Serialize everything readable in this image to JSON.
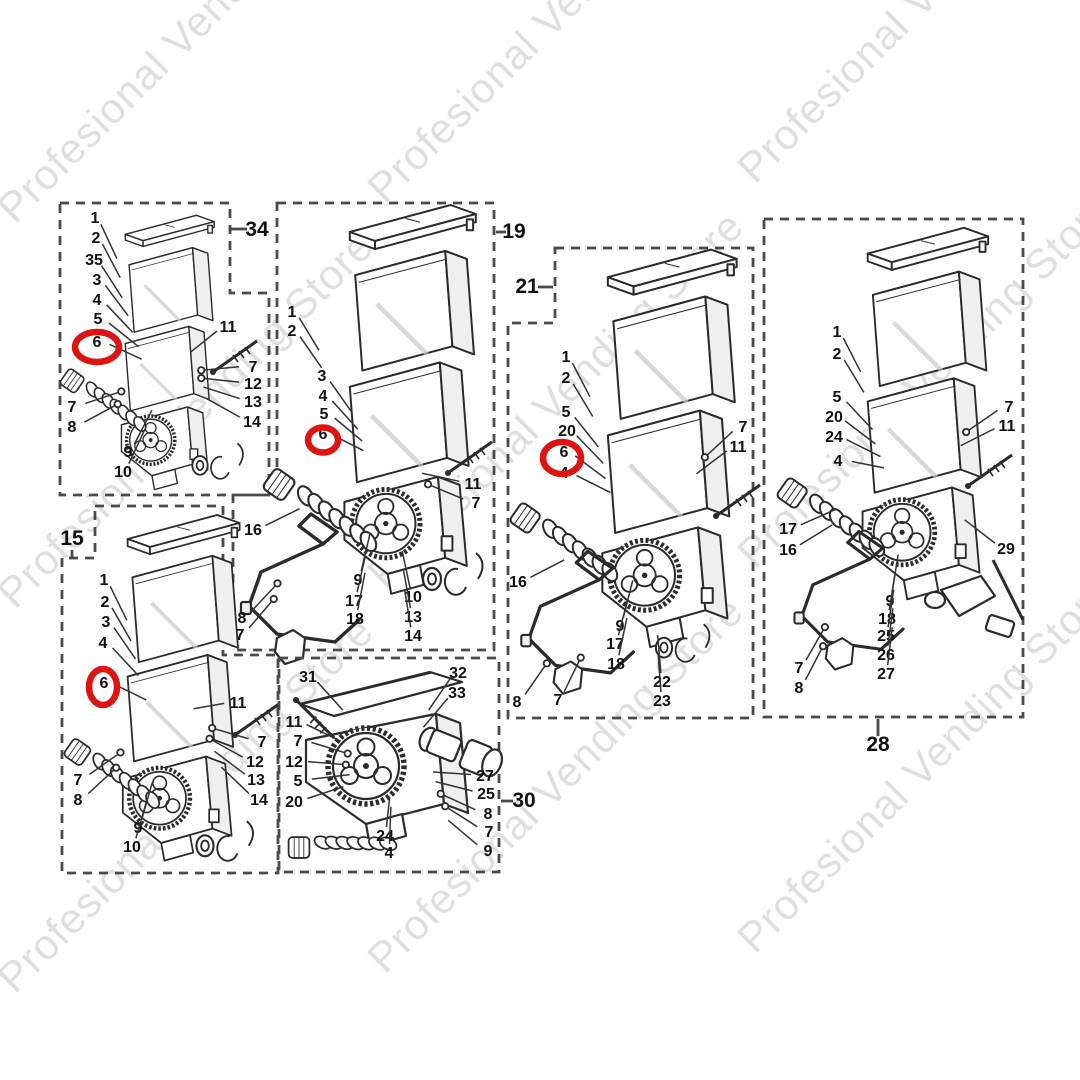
{
  "watermark": {
    "text": "Profesional Vending Store"
  },
  "colors": {
    "line": "#2b2b2b",
    "panel_border": "#4a4a4a",
    "highlight": "#dd1512",
    "watermark": "#c6c6c6"
  },
  "diagram_type": "exploded-parts-diagram",
  "panels": [
    {
      "id": "34",
      "border": "M60,203 H230 V293 H269 V495 H60 Z",
      "label": {
        "text": "34",
        "x": 257,
        "y": 236,
        "tick": [
          231,
          229,
          247,
          229
        ]
      },
      "focus": [
        168,
        380
      ],
      "draw": [
        {
          "sym": "stackA",
          "x": 124,
          "y": 228,
          "s": 0.635
        },
        {
          "sym": "auger",
          "x": 88,
          "y": 388,
          "s": 0.72
        },
        {
          "sym": "screw",
          "x": 213,
          "y": 372,
          "s": 1
        },
        {
          "sym": "clip",
          "x": 200,
          "y": 462,
          "s": 0.85
        }
      ],
      "highlight": {
        "cx": 97,
        "cy": 347,
        "rx": 22,
        "ry": 15
      },
      "parts": [
        [
          "1",
          95,
          223
        ],
        [
          "2",
          96,
          243
        ],
        [
          "35",
          94,
          265
        ],
        [
          "3",
          97,
          285
        ],
        [
          "4",
          97,
          305
        ],
        [
          "5",
          98,
          324
        ],
        [
          "6",
          97,
          347
        ],
        [
          "11",
          228,
          332
        ],
        [
          "7",
          253,
          372
        ],
        [
          "12",
          253,
          389
        ],
        [
          "13",
          253,
          407
        ],
        [
          "14",
          252,
          427
        ],
        [
          "7",
          72,
          412
        ],
        [
          "8",
          72,
          432
        ],
        [
          "9",
          128,
          457
        ],
        [
          "10",
          123,
          477
        ]
      ]
    },
    {
      "id": "19",
      "border": "M277,203 H494 V650 H233 V495 H277 Z",
      "label": {
        "text": "19",
        "x": 514,
        "y": 238,
        "tick": [
          496,
          232,
          506,
          232
        ]
      },
      "focus": [
        385,
        470
      ],
      "draw": [
        {
          "sym": "stackA",
          "x": 348,
          "y": 223,
          "s": 0.9
        },
        {
          "sym": "auger",
          "x": 300,
          "y": 494,
          "s": 0.95
        },
        {
          "sym": "screw",
          "x": 448,
          "y": 473,
          "s": 1
        },
        {
          "sym": "wire",
          "x": 247,
          "y": 520,
          "s": 1
        },
        {
          "sym": "clip",
          "x": 432,
          "y": 575,
          "s": 1
        }
      ],
      "highlight": {
        "cx": 323,
        "cy": 440,
        "rx": 15,
        "ry": 12.5
      },
      "parts": [
        [
          "1",
          292,
          317
        ],
        [
          "2",
          292,
          336
        ],
        [
          "3",
          322,
          381
        ],
        [
          "4",
          323,
          401
        ],
        [
          "5",
          324,
          419
        ],
        [
          "6",
          323,
          439
        ],
        [
          "11",
          473,
          489
        ],
        [
          "7",
          476,
          508
        ],
        [
          "16",
          253,
          535
        ],
        [
          "9",
          358,
          585
        ],
        [
          "10",
          413,
          602
        ],
        [
          "17",
          354,
          606
        ],
        [
          "13",
          413,
          622
        ],
        [
          "18",
          355,
          624
        ],
        [
          "8",
          242,
          623
        ],
        [
          "7",
          240,
          640
        ],
        [
          "14",
          413,
          641
        ]
      ]
    },
    {
      "id": "21",
      "border": "M555,248 H753 V718 H508 V323 H555 Z",
      "label": {
        "text": "21",
        "x": 527,
        "y": 293,
        "tick": [
          538,
          287,
          553,
          287
        ]
      },
      "focus": [
        648,
        520
      ],
      "draw": [
        {
          "sym": "stackA",
          "x": 606,
          "y": 268,
          "s": 0.92
        },
        {
          "sym": "auger",
          "x": 545,
          "y": 527,
          "s": 0.9
        },
        {
          "sym": "screw",
          "x": 716,
          "y": 516,
          "s": 1
        },
        {
          "sym": "wire",
          "x": 527,
          "y": 557,
          "s": 0.95
        },
        {
          "sym": "clip",
          "x": 664,
          "y": 644,
          "s": 0.9
        }
      ],
      "highlight": {
        "cx": 562,
        "cy": 458,
        "rx": 19,
        "ry": 16
      },
      "parts": [
        [
          "1",
          566,
          362
        ],
        [
          "2",
          566,
          383
        ],
        [
          "5",
          566,
          417
        ],
        [
          "20",
          567,
          436
        ],
        [
          "6",
          564,
          457
        ],
        [
          "4",
          564,
          478
        ],
        [
          "7",
          743,
          432
        ],
        [
          "11",
          738,
          452
        ],
        [
          "16",
          518,
          587
        ],
        [
          "9",
          620,
          631
        ],
        [
          "17",
          615,
          649
        ],
        [
          "18",
          616,
          669
        ],
        [
          "22",
          662,
          687
        ],
        [
          "23",
          662,
          706
        ],
        [
          "8",
          517,
          707
        ],
        [
          "7",
          558,
          705
        ]
      ]
    },
    {
      "id": "28",
      "border": "M764,219 H1023 V717 H764 Z",
      "label": {
        "text": "28",
        "x": 878,
        "y": 751,
        "tick": [
          878,
          719,
          878,
          736
        ]
      },
      "focus": [
        910,
        480
      ],
      "draw": [
        {
          "sym": "stackA",
          "x": 866,
          "y": 245,
          "s": 0.86
        },
        {
          "sym": "auger",
          "x": 812,
          "y": 502,
          "s": 0.9
        },
        {
          "sym": "screw",
          "x": 968,
          "y": 486,
          "s": 1
        },
        {
          "sym": "wire",
          "x": 800,
          "y": 537,
          "s": 0.92
        },
        {
          "sym": "lever",
          "x": 935,
          "y": 590,
          "s": 1
        }
      ],
      "highlight": null,
      "parts": [
        [
          "1",
          837,
          337
        ],
        [
          "2",
          837,
          359
        ],
        [
          "5",
          837,
          402
        ],
        [
          "20",
          834,
          422
        ],
        [
          "24",
          834,
          442
        ],
        [
          "4",
          838,
          466
        ],
        [
          "7",
          1009,
          412
        ],
        [
          "11",
          1007,
          431
        ],
        [
          "17",
          788,
          534
        ],
        [
          "16",
          788,
          555
        ],
        [
          "29",
          1006,
          554
        ],
        [
          "9",
          890,
          606
        ],
        [
          "18",
          887,
          624
        ],
        [
          "25",
          886,
          641
        ],
        [
          "26",
          886,
          660
        ],
        [
          "27",
          886,
          679
        ],
        [
          "7",
          799,
          673
        ],
        [
          "8",
          799,
          693
        ]
      ]
    },
    {
      "id": "15",
      "border": "M95,506 H223 V655 H278 V873 H62 V558 H95 Z",
      "label": {
        "text": "15",
        "x": 72,
        "y": 545,
        "tick": [
          72,
          550,
          72,
          557
        ]
      },
      "focus": [
        170,
        720
      ],
      "draw": [
        {
          "sym": "stackA",
          "x": 126,
          "y": 531,
          "s": 0.8
        },
        {
          "sym": "auger",
          "x": 95,
          "y": 760,
          "s": 0.8
        },
        {
          "sym": "screw",
          "x": 235,
          "y": 735,
          "s": 1
        },
        {
          "sym": "clip",
          "x": 205,
          "y": 842,
          "s": 0.95
        }
      ],
      "highlight": {
        "cx": 103,
        "cy": 687,
        "rx": 14,
        "ry": 18
      },
      "parts": [
        [
          "1",
          104,
          585
        ],
        [
          "2",
          105,
          607
        ],
        [
          "3",
          106,
          627
        ],
        [
          "4",
          103,
          648
        ],
        [
          "6",
          104,
          688
        ],
        [
          "11",
          238,
          708
        ],
        [
          "7",
          262,
          747
        ],
        [
          "12",
          255,
          767
        ],
        [
          "13",
          256,
          785
        ],
        [
          "14",
          259,
          805
        ],
        [
          "7",
          78,
          785
        ],
        [
          "8",
          78,
          805
        ],
        [
          "9",
          138,
          833
        ],
        [
          "10",
          132,
          852
        ]
      ]
    },
    {
      "id": "30",
      "border": "M279,658 H499 V872 H279 Z",
      "label": {
        "text": "30",
        "x": 524,
        "y": 807,
        "tick": [
          501,
          801,
          513,
          801
        ]
      },
      "focus": [
        392,
        775
      ],
      "draw": [
        {
          "sym": "stackC",
          "x": 300,
          "y": 676,
          "s": 1
        },
        {
          "sym": "auger",
          "x": 318,
          "y": 844,
          "s": 0.8,
          "r": -35
        },
        {
          "sym": "screw",
          "x": 296,
          "y": 700,
          "s": 1,
          "r": 80
        },
        {
          "sym": "spout",
          "x": 432,
          "y": 730,
          "s": 1
        }
      ],
      "highlight": null,
      "parts": [
        [
          "31",
          308,
          682
        ],
        [
          "11",
          294,
          727
        ],
        [
          "7",
          298,
          746
        ],
        [
          "12",
          294,
          767
        ],
        [
          "5",
          298,
          786
        ],
        [
          "20",
          294,
          807
        ],
        [
          "24",
          385,
          841
        ],
        [
          "4",
          389,
          858
        ],
        [
          "32",
          458,
          678
        ],
        [
          "33",
          457,
          698
        ],
        [
          "27",
          485,
          781
        ],
        [
          "25",
          486,
          799
        ],
        [
          "8",
          488,
          819
        ],
        [
          "7",
          489,
          837
        ],
        [
          "9",
          488,
          856
        ]
      ]
    }
  ]
}
